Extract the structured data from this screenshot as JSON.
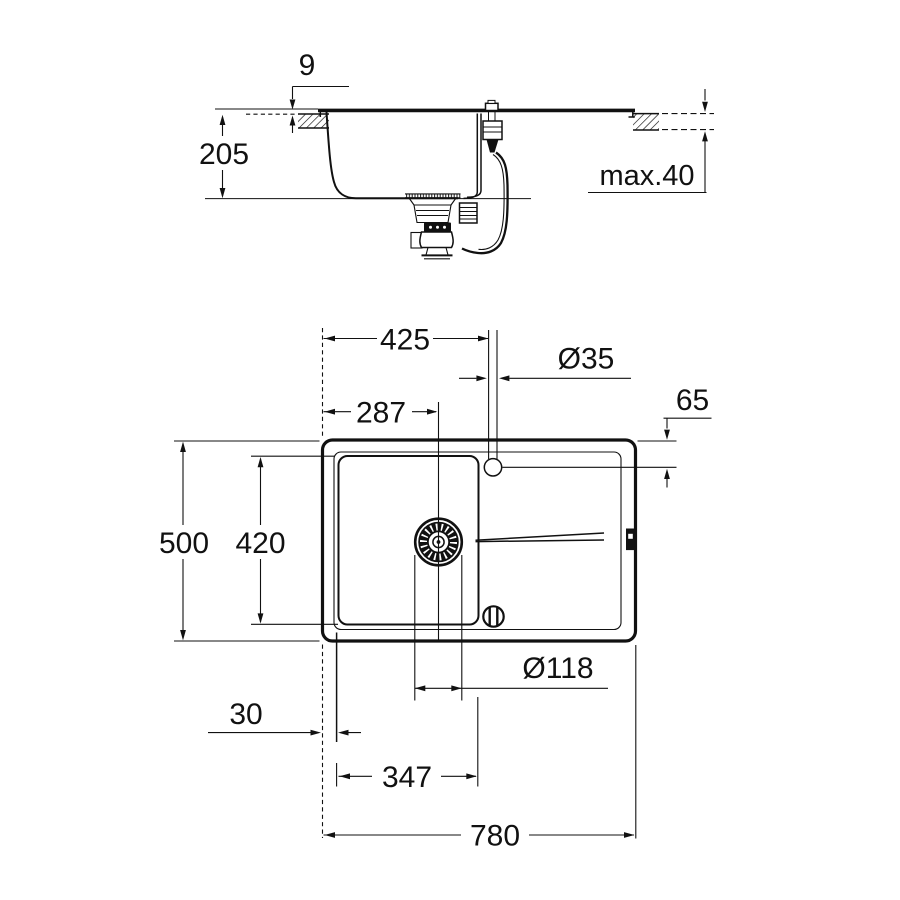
{
  "title": "sink-technical-drawing",
  "colors": {
    "line": "#111111",
    "background": "#ffffff"
  },
  "labels": {
    "side": {
      "rim_height": "9",
      "bowl_depth": "205",
      "counter_thickness": "max.40"
    },
    "plan": {
      "tap_center_from_left": "425",
      "tap_hole_diameter": "Ø35",
      "tap_center_from_edge": "65",
      "drain_center_from_left": "287",
      "overall_depth": "500",
      "bowl_inner_depth": "420",
      "drain_diameter": "Ø118",
      "edge_to_bowl": "30",
      "bowl_inner_width": "347",
      "overall_width": "780"
    }
  }
}
